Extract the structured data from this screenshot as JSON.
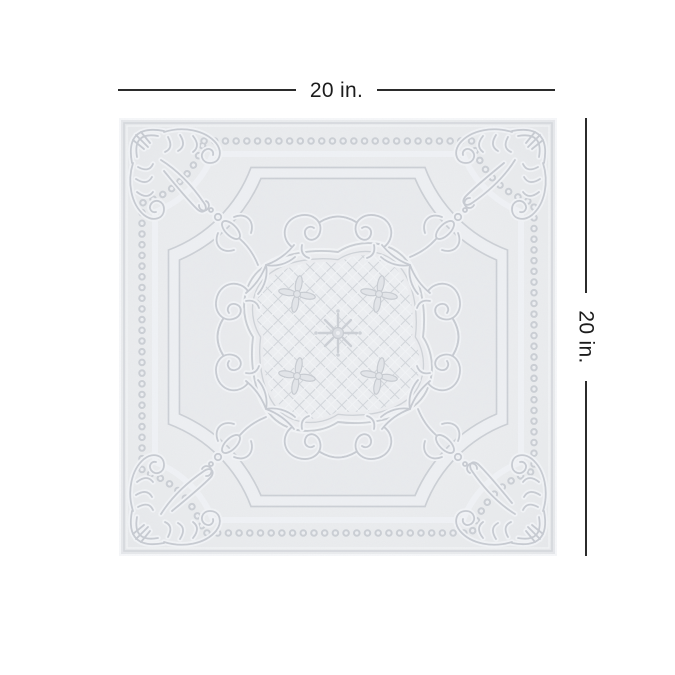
{
  "page": {
    "background_color": "#ffffff"
  },
  "annotation": {
    "top_dimension_label": "20 in.",
    "right_dimension_label": "20 in.",
    "line_color": "#2b2b2b",
    "text_color": "#1c1c1c"
  },
  "product": {
    "kind": "embossed-ceiling-tile",
    "shape": "square",
    "tile_base_color": "#eaecee",
    "tile_pattern_line_color": "#c6cad0",
    "tile_highlight_color": "#f2f4f6",
    "motifs": [
      "beaded-border",
      "corner-acanthus-scrolls",
      "chamfered-inner-frame",
      "fleur-corner-sprigs",
      "paired-c-scrolls",
      "diamond-lattice-medallion",
      "cross-flowers",
      "center-rosette"
    ]
  }
}
